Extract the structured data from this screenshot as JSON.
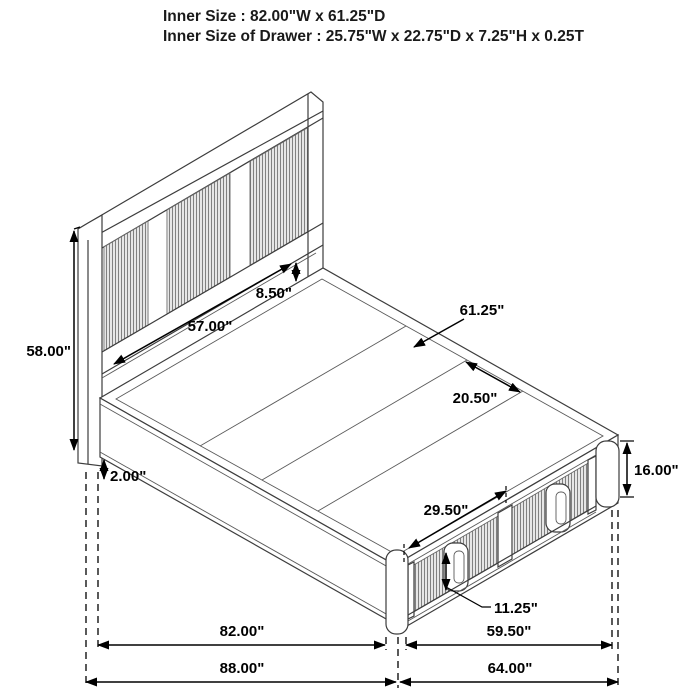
{
  "header": {
    "line1": "Inner Size : 82.00\"W x 61.25\"D",
    "line2": "Inner Size of Drawer : 25.75\"W x 22.75\"D x 7.25\"H x 0.25T"
  },
  "dimensions": {
    "headboard_height": "58.00\"",
    "headboard_panel_width": "57.00\"",
    "headboard_deck_gap": "8.50\"",
    "deck_depth": "61.25\"",
    "deck_board_width": "20.50\"",
    "floor_clearance": "2.00\"",
    "drawer_front_width": "29.50\"",
    "side_height": "16.00\"",
    "drawer_front_height": "11.25\"",
    "inner_width": "82.00\"",
    "drawer_side_length": "59.50\"",
    "overall_width": "88.00\"",
    "overall_depth": "64.00\""
  },
  "colors": {
    "background": "#ffffff",
    "structure_line": "#3d3d3d",
    "dimension_line": "#000000",
    "rib_line": "#808080",
    "text": "#000000"
  }
}
